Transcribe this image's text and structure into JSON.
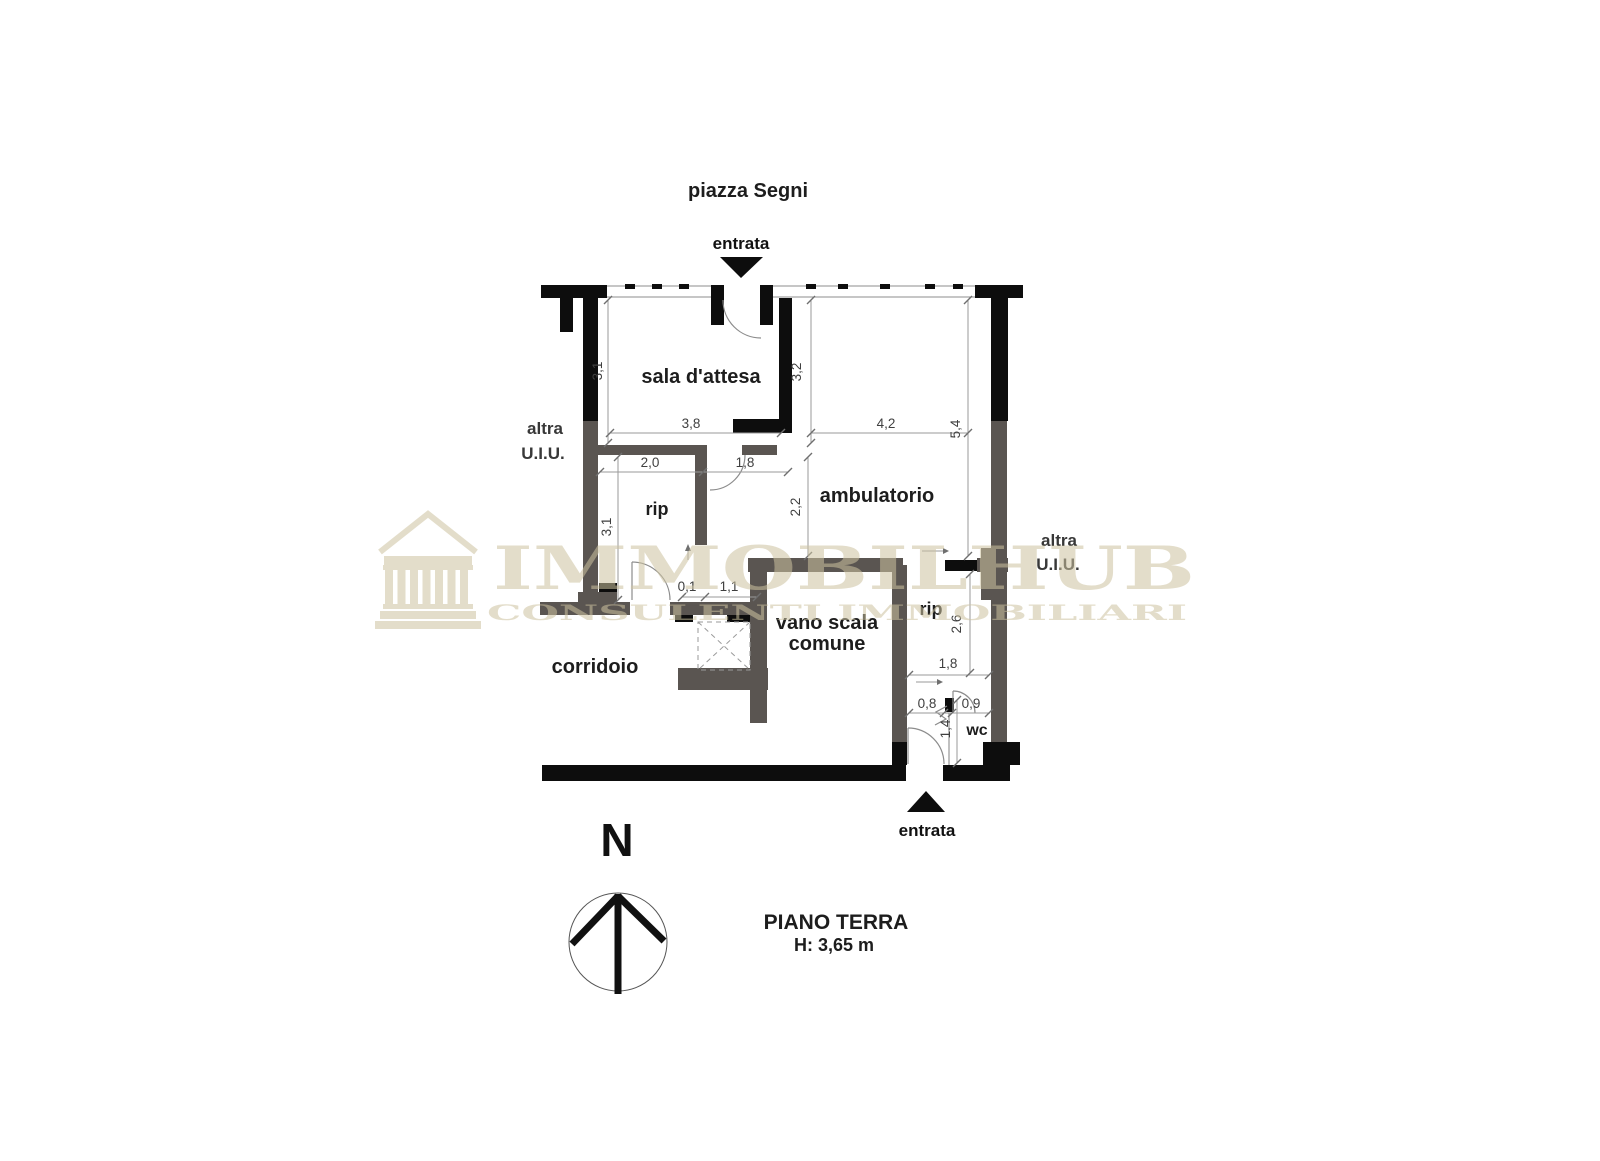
{
  "site": {
    "street": "piazza Segni"
  },
  "entrance_top": {
    "label": "entrata"
  },
  "entrance_bottom": {
    "label": "entrata"
  },
  "rooms": {
    "sala": "sala d'attesa",
    "ambulatorio": "ambulatorio",
    "rip_left": "rip",
    "rip_right": "rip",
    "corridoio": "corridoio",
    "vano_scala_l1": "vano scala",
    "vano_scala_l2": "comune",
    "wc": "wc"
  },
  "adjacent_left": {
    "l1": "altra",
    "l2": "U.I.U."
  },
  "adjacent_right": {
    "l1": "altra",
    "l2": "U.I.U."
  },
  "dims": {
    "sala_h": "3,1",
    "sala_w": "3,8",
    "amb_h": "3,2",
    "amb_w": "4,2",
    "depth": "5,4",
    "rip_w": "2,0",
    "door_w": "1,8",
    "rip_h": "3,1",
    "amb_low": "2,2",
    "gap": "0,1",
    "lift_w": "1,1",
    "rip2_h": "2,6",
    "hall_w": "1,8",
    "wc_a": "0,8",
    "wc_b": "0,9",
    "wc_h": "1,4"
  },
  "compass": {
    "north": "N"
  },
  "floor_info": {
    "title": "PIANO TERRA",
    "height": "H: 3,65 m"
  },
  "watermark": {
    "brand": "IMMOBILHUB",
    "tagline": "CONSULENTI IMMOBILIARI"
  },
  "colors": {
    "wall_black": "#0d0d0d",
    "wall_gray": "#5a5551",
    "watermark": "#cdc3a0",
    "dim_text": "#3f3f3f",
    "label_text": "#1d1d1d"
  }
}
